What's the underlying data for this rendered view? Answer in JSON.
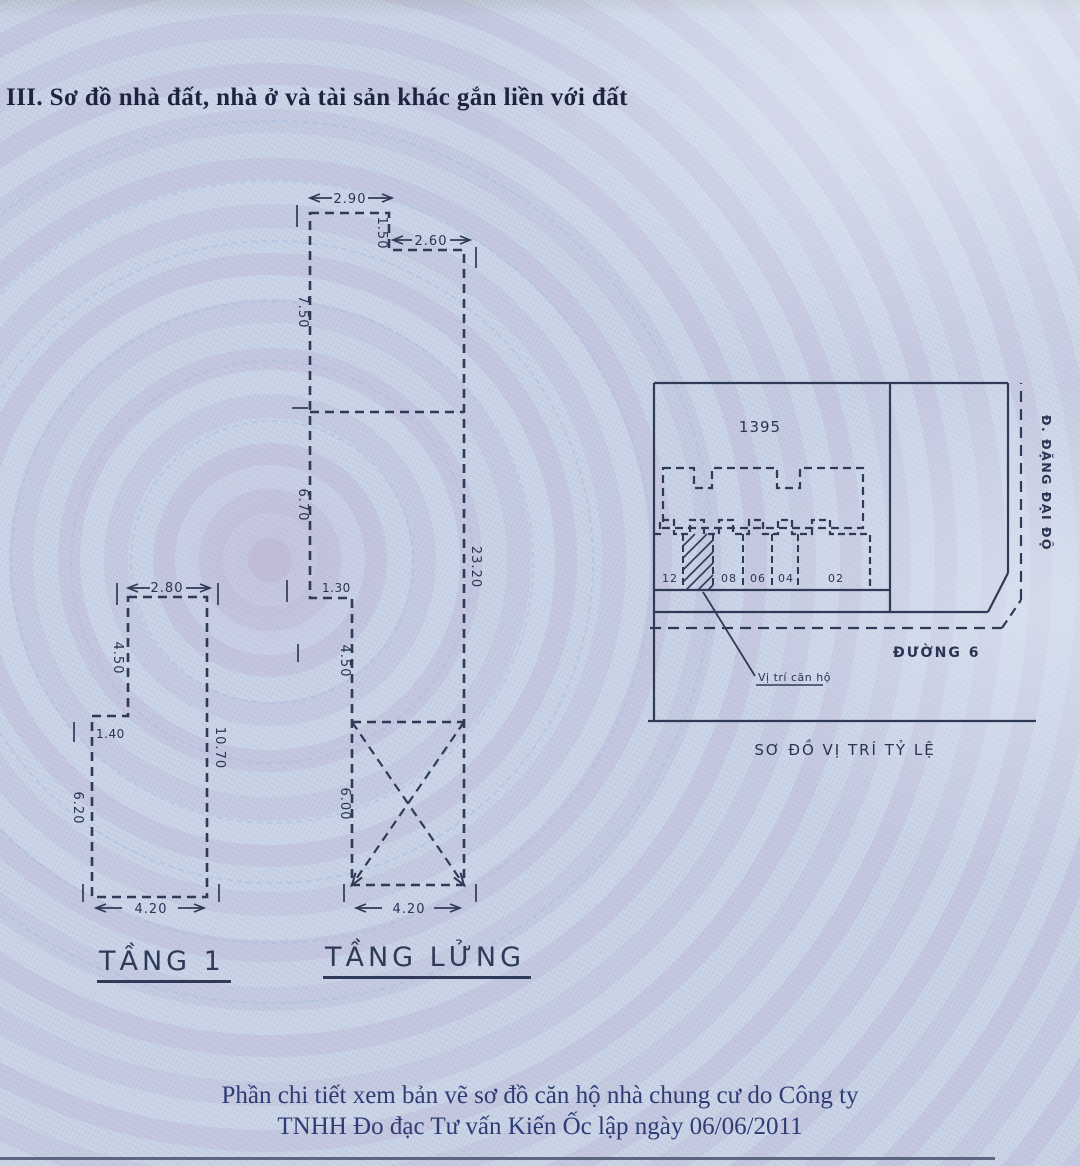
{
  "title": "III. Sơ đồ nhà đất, nhà ở và tài sản khác gắn liền với đất",
  "plans": {
    "tang1": {
      "label": "TẦNG 1",
      "dims": {
        "top": "2.80",
        "left_upper": "4.50",
        "step": "1.40",
        "left_lower": "6.20",
        "right": "10.70",
        "bottom": "4.20"
      }
    },
    "tang_lung": {
      "label": "TẦNG LỬNG",
      "dims": {
        "top": "2.90",
        "notch_depth": "1.50",
        "notch_top": "2.60",
        "left_upper": "7.50",
        "left_mid": "6.70",
        "step": "1.30",
        "left_lower": "4.50",
        "void_height": "6.00",
        "right": "23.20",
        "bottom": "4.20"
      }
    }
  },
  "site_map": {
    "parcel_number": "1395",
    "units": [
      "12",
      "08",
      "06",
      "04",
      "02"
    ],
    "street_bottom": "ĐƯỜNG 6",
    "street_right": "Đ. ĐẶNG ĐẠI ĐỘ",
    "marker_label": "Vị trí căn hộ",
    "caption": "SƠ ĐỒ VỊ TRÍ TỶ LỆ"
  },
  "footer": {
    "line1": "Phần chi tiết xem bản vẽ sơ đồ căn hộ nhà chung cư do Công ty",
    "line2": "TNHH Đo đạc Tư vấn Kiến Ốc lập ngày 06/06/2011"
  },
  "colors": {
    "paper": "#c6d1e4",
    "ink": "#2e3a57",
    "title_ink": "#1c2440",
    "footer_ink": "#2d3c74"
  }
}
